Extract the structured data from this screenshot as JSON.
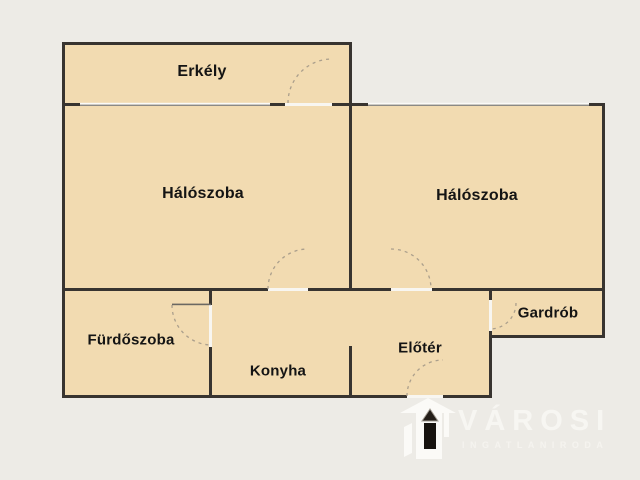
{
  "rooms": [
    {
      "id": "erkely",
      "label": "Erkély"
    },
    {
      "id": "haloszoba_left",
      "label": "Hálószoba"
    },
    {
      "id": "haloszoba_right",
      "label": "Hálószoba"
    },
    {
      "id": "furdoszoba",
      "label": "Fürdőszoba"
    },
    {
      "id": "konyha",
      "label": "Konyha"
    },
    {
      "id": "eloter",
      "label": "Előtér"
    },
    {
      "id": "gardrob",
      "label": "Gardrób"
    }
  ],
  "watermark": {
    "brand": "VÁROSI",
    "tagline": "INGATLANIRODA"
  },
  "colors": {
    "background": "#edebe6",
    "room_fill": "#f2dbb1",
    "wall": "#383430",
    "window_line": "#8b8985",
    "window_glass": "#fbfaf7",
    "door_gap": "#f8f6f1",
    "door_arc": "#ab9f8c",
    "door_leaf": "#6b6862",
    "label_text": "#141414",
    "watermark_text": "#f7f6f2",
    "logo_white": "#fbfaf7",
    "logo_door": "#17130f"
  }
}
